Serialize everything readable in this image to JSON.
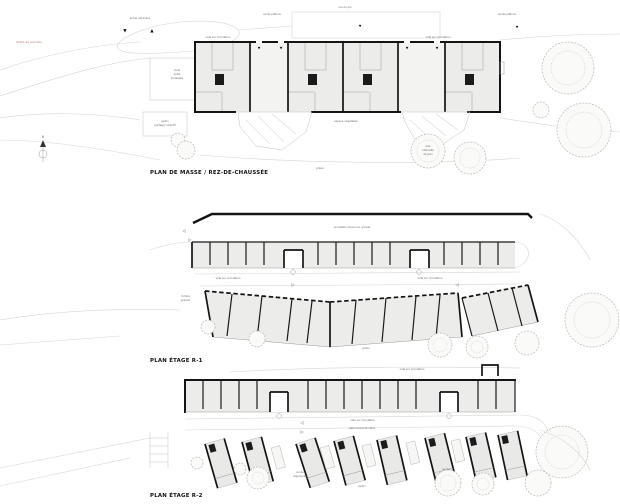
{
  "plans": {
    "site": {
      "title": "PLAN DE MASSE / REZ-DE-CHAUSSÉE",
      "street_label": "rue du pin",
      "access_vehicles": "accès véhicules",
      "access_pedestrians_left": "accès piétons",
      "access_pedestrians_right": "accès piétons",
      "parcel_boundary": "limite de parcelle",
      "void_left": "vide sur circulation",
      "void_right": "vide sur circulation",
      "bike_store_l1": "local",
      "bike_store_l2": "vélos",
      "bike_store_l3": "poubelles",
      "shared_garden_l1": "jardin",
      "shared_garden_l2": "partagé collectif",
      "green_space": "espace végétalisé",
      "playground_l1": "aire",
      "playground_l2": "naturelle",
      "playground_l3": "de jeux",
      "shelter": "préau",
      "north_letter": "N"
    },
    "r1": {
      "title": "PLAN ÉTAGE R-1",
      "path_label": "circulation douce sur gravier",
      "void_left": "vide sur circulation",
      "void_right": "vide sur circulation",
      "roof_l1": "toiture",
      "roof_l2": "gravier",
      "garden": "jardin"
    },
    "r2": {
      "title": "PLAN ÉTAGE R-2",
      "void_top": "vide sur circulation",
      "void_right": "vide sur circulation",
      "bike_parking": "stationnement vélos",
      "access_left_l1": "accès",
      "access_left_l2": "logements",
      "access_right_l1": "accès",
      "access_right_l2": "logements",
      "garden": "jardin"
    }
  },
  "glyphs": {
    "arrow_down": "▼",
    "arrow_up": "▲",
    "tri_left": "◁",
    "tri_right": "▷"
  },
  "colors": {
    "wall": "#141414",
    "floor_fill": "#ececea",
    "context_line": "#d6d6d4",
    "label_text": "#666666",
    "boundary_red": "#c27d77"
  }
}
